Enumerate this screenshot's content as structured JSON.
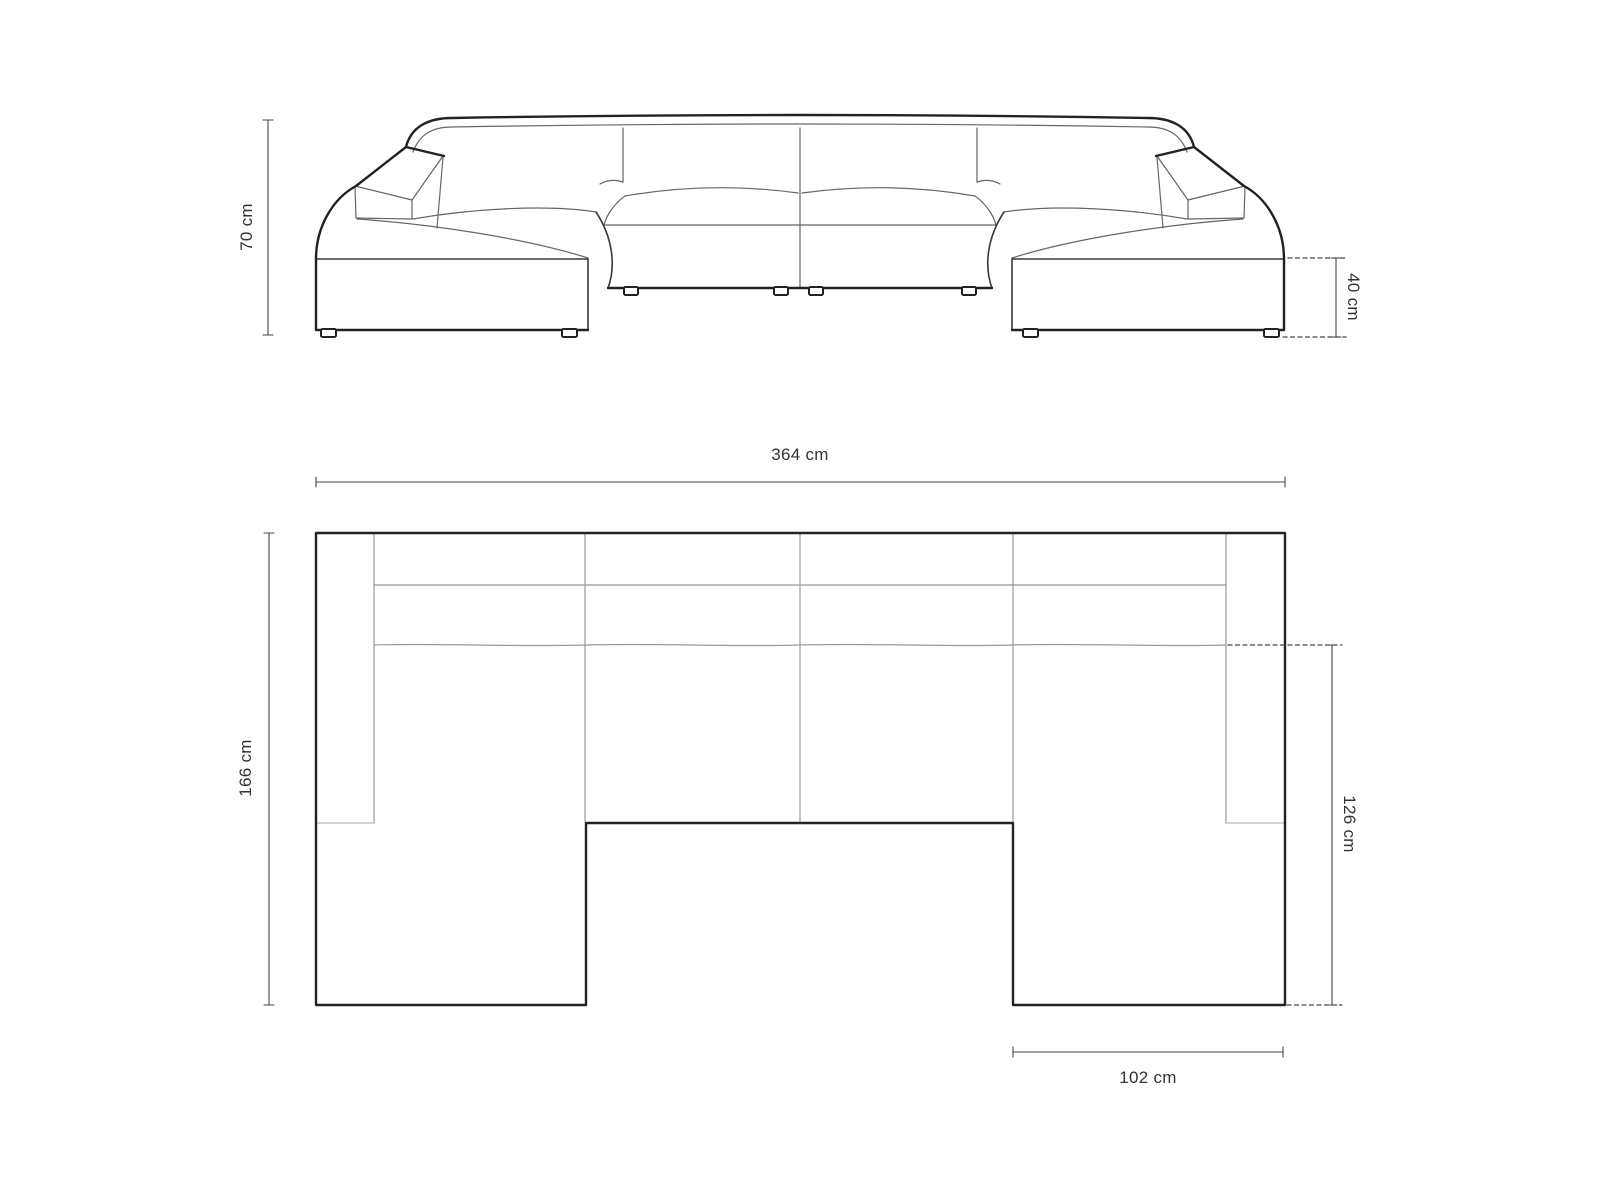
{
  "drawing": {
    "subject": "u-shaped-sofa-dimension-drawing",
    "views": {
      "front_elevation": {
        "name": "front elevation view"
      },
      "top_plan": {
        "name": "top plan view"
      }
    }
  },
  "dims": {
    "total_height": {
      "label": "70 cm",
      "value": 70,
      "unit": "cm",
      "view": "front_elevation",
      "orientation": "vertical"
    },
    "base_height": {
      "label": "40 cm",
      "value": 40,
      "unit": "cm",
      "view": "front_elevation",
      "orientation": "vertical"
    },
    "total_width": {
      "label": "364 cm",
      "value": 364,
      "unit": "cm",
      "view": "top_plan",
      "orientation": "horizontal"
    },
    "total_depth": {
      "label": "166 cm",
      "value": 166,
      "unit": "cm",
      "view": "top_plan",
      "orientation": "vertical"
    },
    "chaise_depth": {
      "label": "126 cm",
      "value": 126,
      "unit": "cm",
      "view": "top_plan",
      "orientation": "vertical"
    },
    "chaise_width": {
      "label": "102 cm",
      "value": 102,
      "unit": "cm",
      "view": "top_plan",
      "orientation": "horizontal"
    }
  },
  "colors": {
    "background": "#ffffff",
    "outline": "#222222",
    "secondary_edge": "#3a3a3a",
    "detail_line": "#666666",
    "plan_seam": "#999999",
    "plan_cap": "#b9b9b9",
    "dimension_line": "#444444",
    "label_text": "#333333"
  }
}
